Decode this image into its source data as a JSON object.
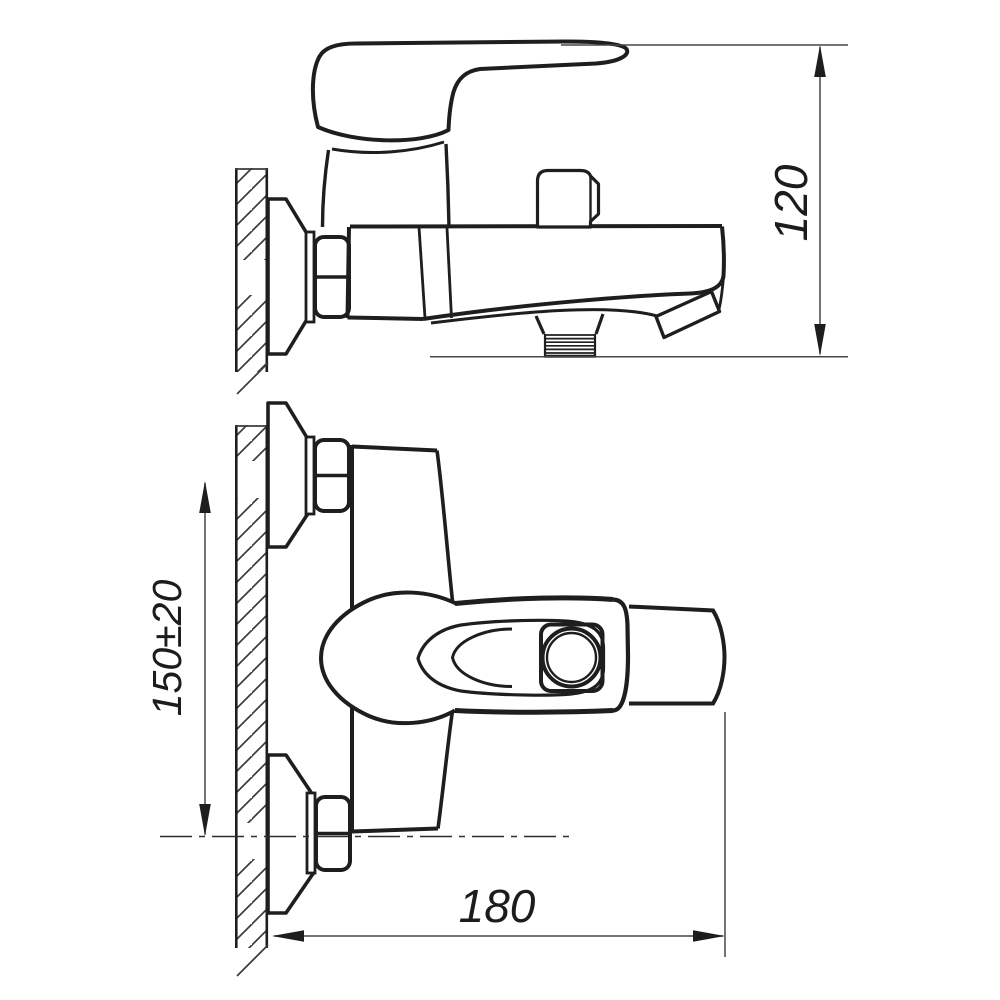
{
  "drawing": {
    "title": "bath-mixer-installation-drawing",
    "colors": {
      "line": "#1e1e1e",
      "thin_line": "#474747",
      "background": "#ffffff"
    },
    "views": {
      "side_view": {
        "name": "side view (wall mounted mixer)"
      },
      "plan_view": {
        "name": "top view (wall mounted mixer)"
      }
    },
    "dimensions": {
      "height": {
        "label": "120"
      },
      "mount_spacing": {
        "label": "150±20"
      },
      "width": {
        "label": "180"
      }
    }
  }
}
